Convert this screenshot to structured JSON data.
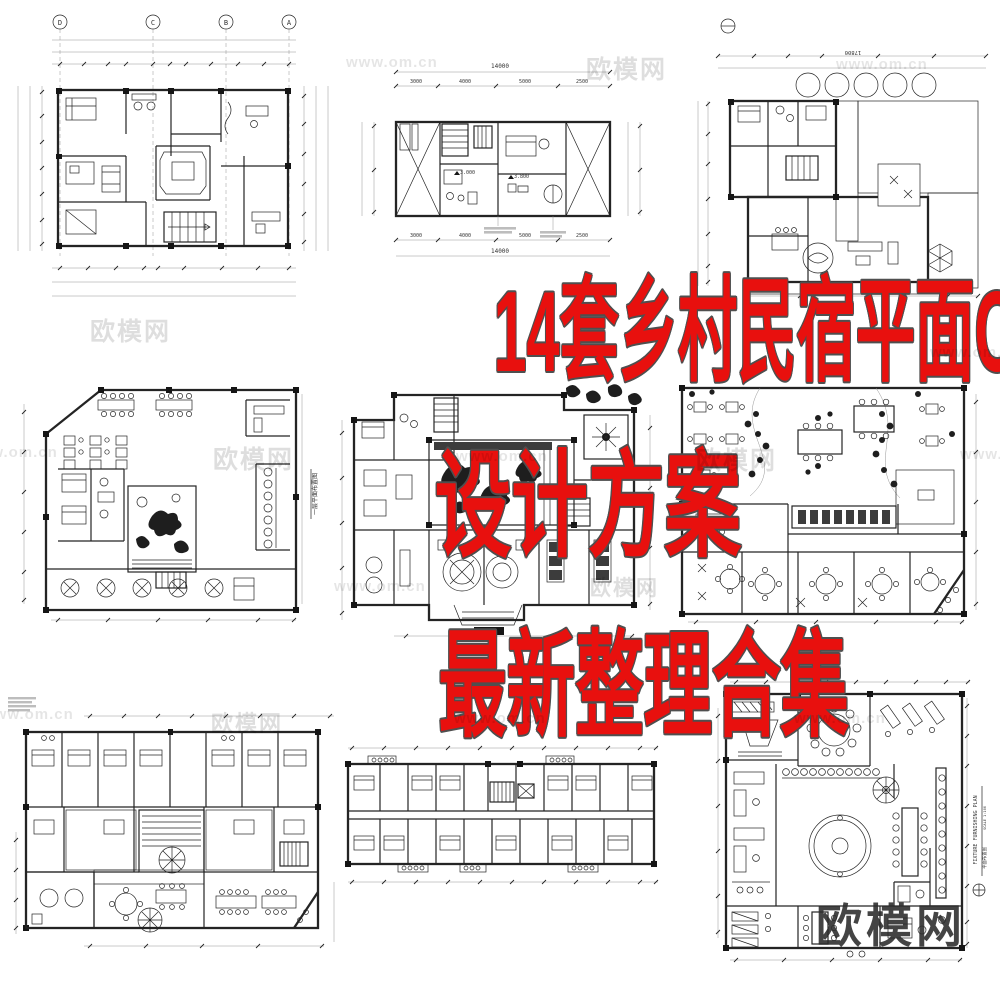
{
  "page": {
    "background": "#ffffff"
  },
  "overlay": {
    "color": "#e8100e",
    "outline_color": "#4f4f4f",
    "line1": "14套乡村民宿平面CAD",
    "line2": "设计方案",
    "line3": "最新整理合集"
  },
  "watermarks": {
    "site_name": "欧模网",
    "site_url": "www.om.cn",
    "corner_logo": "欧模网"
  },
  "plans": {
    "plan1": {
      "name": "villa-upper-floor-plan",
      "grid_letters": [
        "D",
        "C",
        "B",
        "A"
      ]
    },
    "plan2": {
      "name": "narrow-villa-floor-plan",
      "dim_total": "14000",
      "dims": [
        "3000",
        "4000",
        "5000",
        "2500"
      ],
      "level_a": "3.000",
      "level_b": "3.800"
    },
    "plan3": {
      "name": "courtyard-deck-floor-plan",
      "dim_total": "17800"
    },
    "plan4": {
      "name": "guesthouse-ground-floor-plan",
      "side_label": "一层平面布置图"
    },
    "plan5": {
      "name": "homestay-courtyard-plan"
    },
    "plan6": {
      "name": "restaurant-garden-plan"
    },
    "plan7": {
      "name": "guestroom-wing-plan"
    },
    "plan8": {
      "name": "double-loaded-corridor-rooms-plan"
    },
    "plan9": {
      "name": "furnishing-plan",
      "title_en": "FIXTURE FURNISHING PLAN",
      "scale": "SCALE 1:100",
      "title_cn": "平面布置图"
    }
  }
}
